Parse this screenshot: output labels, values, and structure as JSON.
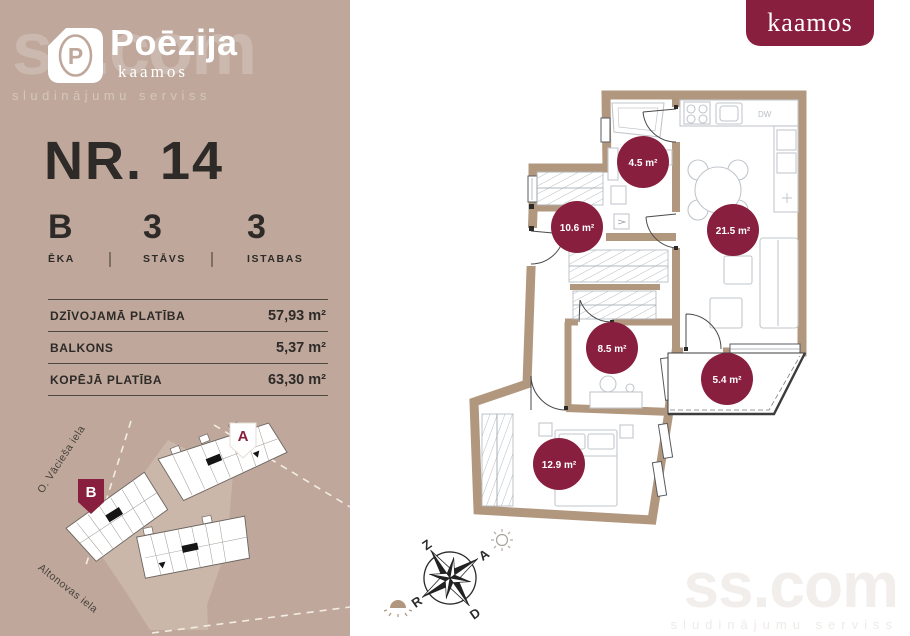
{
  "brand": {
    "project": "Poēzija",
    "sub": "kaamos",
    "developer_logo": "kaamos",
    "logo_letter": "P"
  },
  "watermark": {
    "title": "ss.com",
    "subtitle": "sludinājumu serviss"
  },
  "unit": {
    "number": "NR. 14"
  },
  "stats": [
    {
      "value": "B",
      "label": "ĒKA"
    },
    {
      "value": "3",
      "label": "STĀVS"
    },
    {
      "value": "3",
      "label": "ISTABAS"
    }
  ],
  "areas": [
    {
      "label": "DZĪVOJAMĀ PLATĪBA",
      "value": "57,93 m²"
    },
    {
      "label": "BALKONS",
      "value": "5,37 m²"
    },
    {
      "label": "KOPĒJĀ PLATĪBA",
      "value": "63,30 m²"
    }
  ],
  "floorplan": {
    "rooms": [
      {
        "name": "bathroom",
        "area": "4.5 m²"
      },
      {
        "name": "hallway",
        "area": "10.6 m²"
      },
      {
        "name": "living-kitchen",
        "area": "21.5 m²"
      },
      {
        "name": "room-small",
        "area": "8.5 m²"
      },
      {
        "name": "balcony",
        "area": "5.4 m²"
      },
      {
        "name": "bedroom",
        "area": "12.9 m²"
      }
    ],
    "appliance_label": "DW"
  },
  "compass": {
    "north": "Z",
    "east": "A",
    "south": "D",
    "west": "R"
  },
  "site": {
    "building_a": "A",
    "building_b": "B",
    "streets": [
      "O. Vācieša iela",
      "Altonovas iela"
    ]
  },
  "colors": {
    "background": "#bfa89b",
    "wall": "#b2977f",
    "accent": "#891f3e",
    "text": "#2d2a28"
  }
}
